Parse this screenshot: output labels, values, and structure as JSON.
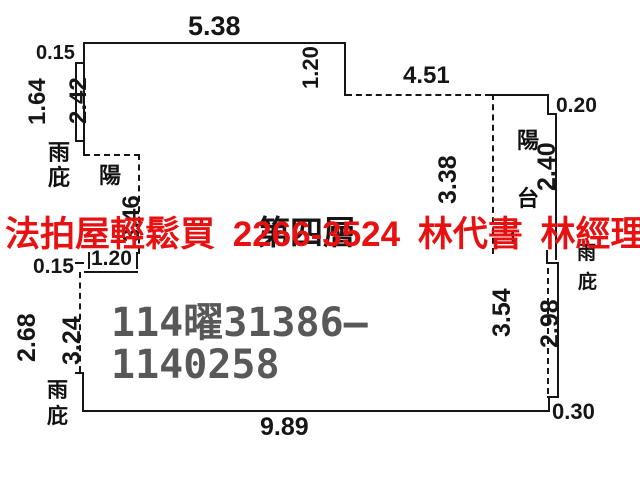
{
  "colors": {
    "background": "#ffffff",
    "line": "#161616",
    "red_overlay": "#e81111",
    "watermark_gray": "#585858"
  },
  "overlay": {
    "red_line": "法拍屋輕鬆買 2266-3524 林代書 林經理"
  },
  "watermark": {
    "line1": "114曜31386—",
    "line2": "1140258"
  },
  "plan": {
    "floor_label": "第四層",
    "obscured_label": ".1",
    "labels": {
      "canopy_top_left": [
        "雨",
        "庇"
      ],
      "balcony_left": [
        "陽"
      ],
      "balcony_right": [
        "陽",
        "台"
      ],
      "canopy_right": [
        "雨",
        "庇"
      ],
      "canopy_bottom_left": [
        "雨",
        "庇"
      ]
    },
    "dims": {
      "top_width": "5.38",
      "offset_top_left": "0.15",
      "left_outer_upper": "1.64",
      "left_inner_upper": "2.42",
      "balcony_left_height": "3.46",
      "step_top_right": "1.20",
      "top_right_width": "4.51",
      "notch_right": "0.20",
      "balcony_right_inner": "3.38",
      "right_upper": "2.40",
      "offset_mid_left": "0.15",
      "balcony_left_width": "1.20",
      "left_outer_lower": "2.68",
      "left_inner_lower": "3.24",
      "right_inner_lower": "3.54",
      "right_outer_lower": "2.98",
      "offset_bottom_right": "0.30",
      "bottom_width": "9.89"
    }
  }
}
